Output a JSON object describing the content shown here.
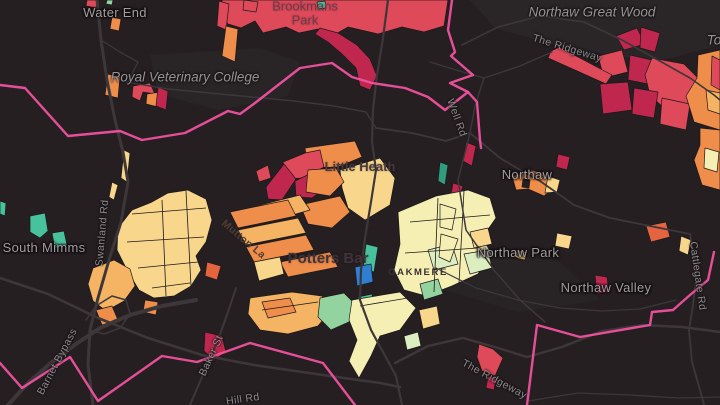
{
  "map": {
    "background": "#251f22",
    "colors": {
      "red": "#df4a5b",
      "crimson": "#c0274f",
      "redOrange": "#e4643f",
      "orange": "#ef8d4b",
      "lightOrange": "#f5b364",
      "cream": "#f8d78d",
      "paleYellow": "#f5efb4",
      "paleGreen": "#dcedc0",
      "green": "#93d39f",
      "teal": "#48c19d",
      "tealDark": "#2f9c80",
      "blue": "#2e7ed2",
      "gold": "#eec06a",
      "bgDot": "#241f21",
      "boundary": "#f0529f",
      "road": "#3d3739",
      "parcel": "#1d181a"
    },
    "patches": [
      {
        "fill": "#2a2527",
        "points": "470,0 720,0 720,45 655,62 565,48 495,28"
      },
      {
        "fill": "#292425",
        "points": "150,55 260,48 300,62 288,96 218,110 158,94"
      },
      {
        "fill": "#282324",
        "points": "430,242 560,262 600,300 518,312 438,288"
      }
    ],
    "polygons": [
      {
        "color": "red",
        "points": "222,0 448,0 444,26 424,32 402,27 378,34 348,27 332,36 318,29 299,33 286,27 263,33 255,21 241,28 228,24 222,14"
      },
      {
        "color": "crimson",
        "points": "320,28 338,33 357,45 370,59 377,76 370,90 360,86 356,68 342,54 328,42 315,34"
      },
      {
        "color": "red",
        "points": "219,1 229,4 226,30 217,26"
      },
      {
        "color": "orange",
        "points": "226,26 238,29 235,62 222,56"
      },
      {
        "color": "red",
        "points": "244,0 258,2 256,12 243,10"
      },
      {
        "color": "teal",
        "points": "317,2 325,1 326,8 318,9"
      },
      {
        "color": "red",
        "points": "87,0 98,0 96,8 86,6"
      },
      {
        "color": "green",
        "points": "107,0 113,0 112,5 106,4"
      },
      {
        "color": "orange",
        "points": "112,17 121,19 119,31 110,29"
      },
      {
        "color": "orange",
        "points": "108,74 120,77 118,98 105,95"
      },
      {
        "color": "red",
        "points": "133,86 150,83 155,94 143,92 140,101 132,97"
      },
      {
        "color": "orange",
        "points": "147,94 160,92 158,107 146,104"
      },
      {
        "color": "crimson",
        "points": "158,87 168,91 166,110 156,106"
      },
      {
        "color": "crimson",
        "points": "616,36 637,28 645,44 624,50"
      },
      {
        "color": "crimson",
        "points": "641,27 660,33 655,52 640,48"
      },
      {
        "color": "red",
        "points": "598,56 622,50 628,72 604,78"
      },
      {
        "color": "crimson",
        "points": "630,55 652,60 648,84 628,80"
      },
      {
        "color": "red",
        "points": "652,58 684,64 700,80 695,108 668,112 650,95 645,75"
      },
      {
        "color": "crimson",
        "points": "600,84 628,82 632,110 603,114"
      },
      {
        "color": "crimson",
        "points": "634,88 658,92 654,118 632,114"
      },
      {
        "color": "red",
        "points": "662,98 690,104 686,130 660,124"
      },
      {
        "color": "orange",
        "points": "698,55 720,50 720,130 694,122 686,96 697,78"
      },
      {
        "color": "red",
        "points": "712,56 720,60 720,90 711,85"
      },
      {
        "color": "lightOrange",
        "points": "706,90 720,93 720,114 708,110"
      },
      {
        "color": "orange",
        "points": "700,128 720,130 720,190 702,185 694,160 700,145"
      },
      {
        "color": "paleYellow",
        "points": "705,148 719,152 717,172 704,168"
      },
      {
        "color": "red",
        "points": "551,51 559,47 612,75 606,84 548,58"
      },
      {
        "color": "crimson",
        "points": "558,154 570,157 567,170 556,167"
      },
      {
        "color": "crimson",
        "points": "466,142 476,146 472,166 463,161"
      },
      {
        "color": "crimson",
        "points": "453,183 463,186 459,198 451,194"
      },
      {
        "color": "tealDark",
        "points": "440,162 448,165 445,185 438,181"
      },
      {
        "color": "orange",
        "points": "512,176 532,170 549,175 556,186 544,196 528,189 516,190"
      },
      {
        "color": "cream",
        "points": "548,176 560,180 557,192 545,193"
      },
      {
        "color": "bgDot",
        "points": "523,179 530,180 529,188 522,187"
      },
      {
        "color": "redOrange",
        "points": "646,226 666,222 670,237 651,242"
      },
      {
        "color": "cream",
        "points": "681,236 691,240 688,255 679,251"
      },
      {
        "color": "gold",
        "points": "517,250 527,252 525,260 516,258"
      },
      {
        "color": "crimson",
        "points": "595,275 607,277 609,292 597,294"
      },
      {
        "color": "orange",
        "points": "305,148 355,141 362,157 338,167 308,168"
      },
      {
        "color": "red",
        "points": "283,162 305,153 320,150 324,167 303,178 287,179"
      },
      {
        "color": "crimson",
        "points": "266,187 284,164 296,179 282,200 268,199"
      },
      {
        "color": "crimson",
        "points": "295,181 318,170 331,184 312,198 296,197"
      },
      {
        "color": "red",
        "points": "256,171 268,165 271,178 259,182"
      },
      {
        "color": "cream",
        "points": "340,170 380,158 395,178 390,205 365,220 348,208 342,188"
      },
      {
        "color": "orange",
        "points": "308,170 336,168 344,182 330,196 306,192"
      },
      {
        "color": "orange",
        "points": "300,205 340,196 350,212 332,228 308,224"
      },
      {
        "color": "lightOrange",
        "points": "260,205 300,195 310,210 268,222"
      },
      {
        "color": "orange",
        "points": "230,212 288,200 296,216 238,228"
      },
      {
        "color": "lightOrange",
        "points": "238,230 298,218 306,233 246,245"
      },
      {
        "color": "orange",
        "points": "246,247 306,235 314,250 254,262"
      },
      {
        "color": "cream",
        "points": "118,228 132,210 152,202 168,193 188,190 206,199 212,220 206,242 196,256 201,270 191,286 174,296 154,298 139,290 127,270 117,250"
      },
      {
        "color": "lightOrange",
        "points": "93,268 114,260 130,269 135,286 124,301 106,311 93,301 88,284"
      },
      {
        "color": "orange",
        "points": "96,310 112,306 118,320 102,325"
      },
      {
        "color": "orange",
        "points": "145,300 158,302 156,315 143,312"
      },
      {
        "color": "redOrange",
        "points": "207,262 221,266 217,280 205,276"
      },
      {
        "color": "crimson",
        "points": "205,332 222,336 226,352 214,360 204,351"
      },
      {
        "color": "lightOrange",
        "points": "250,298 292,292 322,296 332,309 318,326 288,334 260,330 248,314"
      },
      {
        "color": "orange",
        "points": "262,302 290,298 296,312 268,318"
      },
      {
        "color": "cream",
        "points": "124,150 130,153 127,182 121,178"
      },
      {
        "color": "cream",
        "points": "112,182 118,185 114,200 109,197"
      },
      {
        "color": "paleYellow",
        "points": "398,212 436,196 468,190 490,198 496,218 482,238 492,254 478,274 452,286 426,296 404,290 394,270 400,244"
      },
      {
        "color": "cream",
        "points": "470,232 488,228 492,244 474,248"
      },
      {
        "color": "paleGreen",
        "points": "428,250 452,244 458,264 434,270"
      },
      {
        "color": "paleGreen",
        "points": "464,254 488,250 492,268 470,274"
      },
      {
        "color": "green",
        "points": "420,284 438,279 443,294 424,300"
      },
      {
        "color": "paleYellow",
        "points": "440,204 456,209 452,230 440,227"
      },
      {
        "color": "paleYellow",
        "points": "441,234 458,239 450,262 439,257"
      },
      {
        "color": "cream",
        "points": "557,233 572,236 569,249 555,246"
      },
      {
        "color": "teal",
        "points": "366,244 378,247 374,272 363,268"
      },
      {
        "color": "blue",
        "points": "355,267 371,264 373,282 357,286"
      },
      {
        "color": "green",
        "points": "320,298 344,293 355,304 349,322 331,330 318,317"
      },
      {
        "color": "teal",
        "points": "358,297 372,294 375,310 361,314"
      },
      {
        "color": "paleYellow",
        "points": "352,300 400,292 416,308 400,330 380,336 371,356 359,378 349,361 357,340 349,320"
      },
      {
        "color": "cream",
        "points": "419,310 437,306 440,324 423,329"
      },
      {
        "color": "red",
        "points": "479,344 493,349 503,358 495,376 482,371 477,357"
      },
      {
        "color": "crimson",
        "points": "488,376 496,378 494,390 486,388"
      },
      {
        "color": "teal",
        "points": "30,216 45,213 48,231 40,238 30,232"
      },
      {
        "color": "teal",
        "points": "52,233 64,231 67,245 55,249"
      },
      {
        "color": "teal",
        "points": "0,201 6,203 5,216 0,214"
      },
      {
        "color": "orange",
        "points": "280,262 330,252 338,267 288,277"
      },
      {
        "color": "cream",
        "points": "254,262 280,257 284,274 259,281"
      },
      {
        "color": "paleGreen",
        "points": "404,336 418,332 421,346 407,350"
      }
    ],
    "parcel_lines": [
      "132,214 206,208",
      "127,242 204,237",
      "138,268 198,262",
      "152,288 190,283",
      "162,200 166,296",
      "186,191 191,286",
      "410,222 490,215",
      "405,253 478,248",
      "438,198 434,292",
      "464,191 459,283",
      "360,306 408,298",
      "262,310 318,302"
    ],
    "roads": [
      {
        "name": "west-main-road",
        "width": 3,
        "points": "97,0 101,40 107,80 115,120 123,152 128,182 121,222 109,260 98,298 90,330 88,365 93,405"
      },
      {
        "name": "potters-bar-high-st",
        "width": 2.2,
        "points": "388,0 383,38 377,75 373,110 372,142 376,170 371,202 365,238 361,270 360,300 371,330 383,352 396,376 402,405"
      },
      {
        "name": "great-wood-lane",
        "width": 1.6,
        "points": "462,45 498,27 540,16 584,22 622,40 658,60 690,78 714,95 720,100"
      },
      {
        "name": "northaw-road",
        "width": 1.8,
        "points": "376,128 412,133 446,141 470,133 500,158 522,171 540,181 574,205 610,218 650,226 690,234"
      },
      {
        "name": "well-rd-branch",
        "width": 1.4,
        "points": "430,62 456,70 484,78 520,66 552,52"
      },
      {
        "name": "well-rd-vertical",
        "width": 1.4,
        "points": "484,78 475,106 470,133"
      },
      {
        "name": "northaw-south-lane",
        "width": 1.5,
        "points": "470,133 458,180 466,230 494,270 520,300 545,322"
      },
      {
        "name": "cattlegate-rd",
        "width": 1.8,
        "points": "690,234 694,258 696,280 693,305 689,330 692,362 700,390 704,405"
      },
      {
        "name": "bottom-curve",
        "width": 2.6,
        "points": "0,278 48,294 98,318 148,338 202,355 254,365 302,372 344,378 380,383 400,387"
      },
      {
        "name": "ridgeway-south",
        "width": 2.4,
        "points": "395,363 428,346 463,338 498,348 527,357 562,347 602,331 642,325 682,327 720,332"
      },
      {
        "name": "baker-st-road",
        "width": 2,
        "points": "190,405 205,370 218,340 228,312 236,288"
      },
      {
        "name": "barnet-bypass-road",
        "width": 4,
        "points": "8,405 28,383 52,362 76,344 100,328 130,315 162,306 196,300"
      },
      {
        "name": "bottom-faint-lane",
        "width": 1.3,
        "points": "528,401 578,393 630,395 678,398 720,397"
      },
      {
        "name": "rvc-east-lane",
        "width": 1.4,
        "points": "126,82 168,89 210,93 252,97 294,101 334,106 366,112 376,128"
      },
      {
        "name": "northaw-park-lane",
        "width": 1.2,
        "points": "436,268 476,288 518,300 560,308 602,311 640,309 676,300"
      },
      {
        "name": "interchange-loop",
        "width": 1.5,
        "points": "86,320 96,306 112,296 126,300 130,314 120,328 104,334 90,330"
      },
      {
        "name": "water-end-branch",
        "width": 1.3,
        "points": "101,40 120,52 138,62 128,82"
      }
    ],
    "boundaries": [
      {
        "name": "boundary-west",
        "points": "0,85 25,88 68,136 120,131 142,140 185,133 228,111 240,114 255,103 300,68 332,63 352,77 372,83 405,88 428,97 445,110 468,92 450,83 473,75 451,56 455,52 448,30 452,0"
      },
      {
        "name": "boundary-branch",
        "points": "468,92 477,102 480,140 481,148"
      },
      {
        "name": "boundary-southwest",
        "points": "0,363 22,388 70,357 98,401 162,356 197,362 250,343 323,363 355,405"
      },
      {
        "name": "boundary-southeast",
        "points": "714,252 708,280 690,295 673,310 652,312 650,325 580,337 537,325 527,405"
      }
    ],
    "labels": [
      {
        "id": "water-end",
        "text": "Water End",
        "x": 115,
        "y": 13,
        "rotate": 0,
        "style": "place"
      },
      {
        "id": "brookmans-park",
        "text": "Brookmans Park",
        "x": 305,
        "y": 14,
        "rotate": 0,
        "style": "place-dark"
      },
      {
        "id": "northaw-great-wood",
        "text": "Northaw Great Wood",
        "x": 592,
        "y": 13,
        "rotate": 0,
        "style": "wood"
      },
      {
        "id": "the-ridgeway-north",
        "text": "The Ridgeway",
        "x": 567,
        "y": 49,
        "rotate": 17,
        "style": "road-lbl"
      },
      {
        "id": "royal-veterinary-college",
        "text": "Royal Veterinary College",
        "x": 185,
        "y": 78,
        "rotate": 0,
        "style": "wood"
      },
      {
        "id": "well-rd",
        "text": "Well Rd",
        "x": 456,
        "y": 118,
        "rotate": 70,
        "style": "road-lbl"
      },
      {
        "id": "little-heath",
        "text": "Little Heath",
        "x": 360,
        "y": 167,
        "rotate": 0,
        "style": "suburb"
      },
      {
        "id": "northaw",
        "text": "Northaw",
        "x": 527,
        "y": 175,
        "rotate": 0,
        "style": "place"
      },
      {
        "id": "south-mimms",
        "text": "South Mimms",
        "x": 44,
        "y": 248,
        "rotate": 0,
        "style": "place"
      },
      {
        "id": "swanland-rd",
        "text": "Swanland Rd",
        "x": 103,
        "y": 233,
        "rotate": -85,
        "style": "road-lbl"
      },
      {
        "id": "mutton-la",
        "text": "Mutton La",
        "x": 243,
        "y": 240,
        "rotate": 40,
        "style": "road-dark"
      },
      {
        "id": "potters-bar",
        "text": "Potters Bar",
        "x": 328,
        "y": 259,
        "rotate": 0,
        "style": "town"
      },
      {
        "id": "oakmere",
        "text": "OAKMERE",
        "x": 418,
        "y": 273,
        "rotate": 0,
        "style": "district"
      },
      {
        "id": "northaw-park",
        "text": "Northaw Park",
        "x": 518,
        "y": 253,
        "rotate": 0,
        "style": "place"
      },
      {
        "id": "northaw-valley",
        "text": "Northaw Valley",
        "x": 606,
        "y": 288,
        "rotate": 0,
        "style": "place"
      },
      {
        "id": "cattlegate-rd",
        "text": "Cattlegate Rd",
        "x": 697,
        "y": 276,
        "rotate": 82,
        "style": "road-lbl"
      },
      {
        "id": "barnet-bypass",
        "text": "Barnet Bypass",
        "x": 58,
        "y": 362,
        "rotate": -62,
        "style": "road-lbl"
      },
      {
        "id": "baker-st",
        "text": "Baker St",
        "x": 212,
        "y": 356,
        "rotate": -65,
        "style": "road-lbl"
      },
      {
        "id": "hill-rd",
        "text": "Hill Rd",
        "x": 243,
        "y": 400,
        "rotate": -8,
        "style": "road-lbl"
      },
      {
        "id": "the-ridgeway-south",
        "text": "The Ridgeway",
        "x": 494,
        "y": 380,
        "rotate": 28,
        "style": "road-lbl"
      },
      {
        "id": "to-fragment",
        "text": "To",
        "x": 714,
        "y": 41,
        "rotate": 0,
        "style": "wood"
      }
    ]
  }
}
